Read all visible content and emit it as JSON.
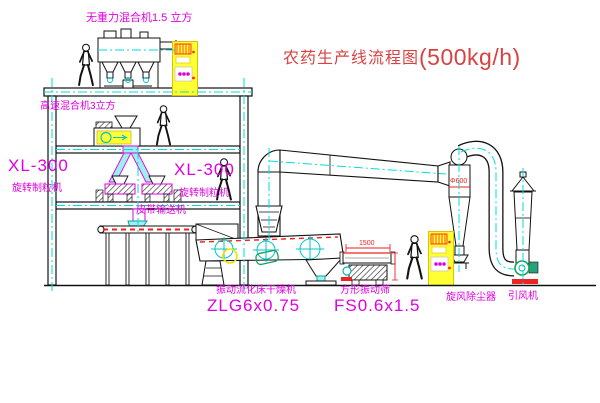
{
  "title": {
    "text": "农药生产线流程图",
    "capacity": "(500kg/h)"
  },
  "equipment_labels": {
    "gravity_mixer": "无重力混合机1.5 立方",
    "highspeed_mixer": "高速混合机3立方",
    "granulator_left": {
      "model": "XL-300",
      "name": "旋转制粒机"
    },
    "granulator_right": {
      "model": "XL-300",
      "name": "旋转制粒机"
    },
    "belt_conveyor": "皮带输送机",
    "fluid_bed_dryer": {
      "name": "振动流化床干燥机",
      "model": "ZLG6x0.75"
    },
    "square_sieve": {
      "name": "方形振动筛",
      "model": "FS0.6x1.5"
    },
    "cyclone": "旋风除尘器",
    "fan": "引风机"
  },
  "dimensions": {
    "sieve_length": "1500",
    "cyclone_diameter": "Φ600"
  },
  "colors": {
    "label_magenta": "#e000e0",
    "title_red": "#d84242",
    "centerline_cyan": "#00dede",
    "cabinet_yellow": "#ffff33",
    "dimension_red": "#ee2222",
    "line_black": "#111111"
  }
}
